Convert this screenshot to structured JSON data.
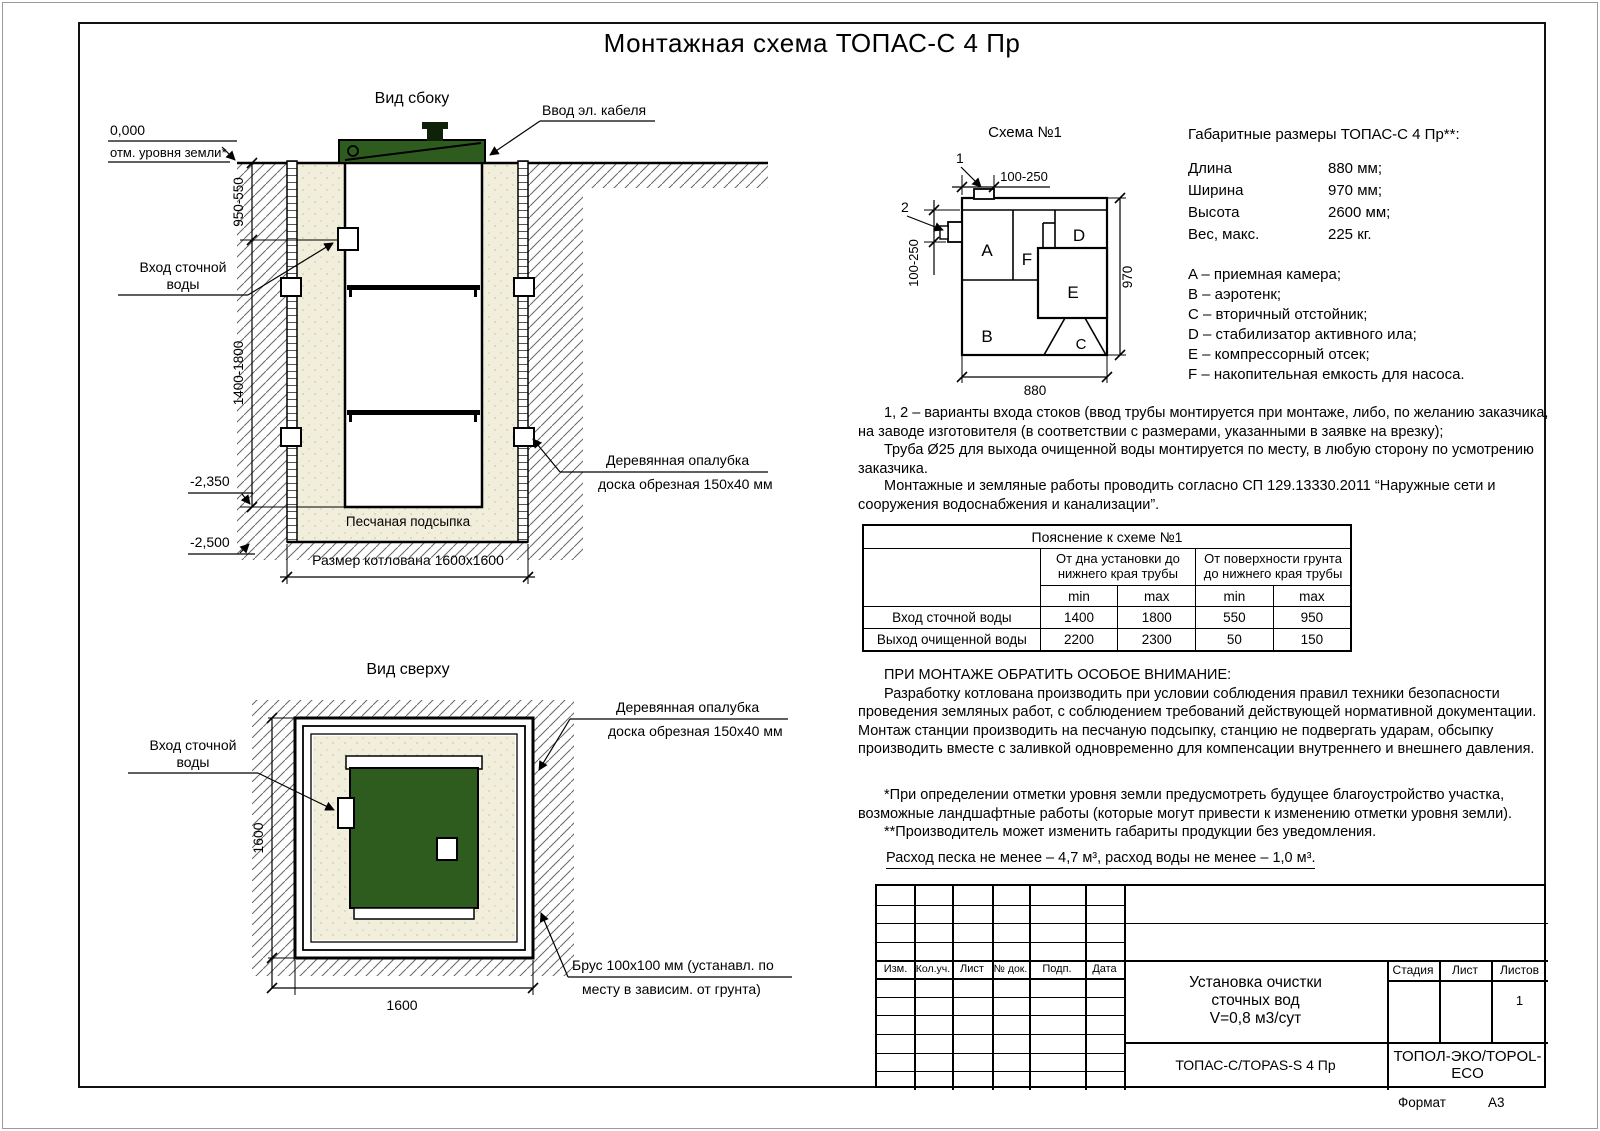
{
  "page": {
    "title": "Монтажная схема ТОПАС-С 4 Пр",
    "format_label": "Формат",
    "format_value": "А3"
  },
  "side_view": {
    "title": "Вид сбоку",
    "cable_label": "Ввод эл. кабеля",
    "level_zero": "0,000",
    "level_zero_note": "отм. уровня земли*",
    "dim_top": "950-550",
    "dim_mid": "1400-1800",
    "level_minus_1": "-2,350",
    "level_minus_2": "-2,500",
    "sand_label": "Песчаная подсыпка",
    "pit_label": "Размер котлована 1600х1600"
  },
  "top_view": {
    "title": "Вид сверху",
    "dim_side": "1600",
    "dim_bottom": "1600",
    "brus_line1": "Брус 100х100 мм (устанавл. по",
    "brus_line2": "месту в зависим. от грунта)"
  },
  "shared": {
    "inlet_line1": "Вход сточной",
    "inlet_line2": "воды",
    "formwork_line1": "Деревянная опалубка",
    "formwork_line2": "доска обрезная 150х40 мм"
  },
  "schema": {
    "title": "Схема №1",
    "marker_1": "1",
    "marker_2": "2",
    "dim_top": "100-250",
    "dim_left": "100-250",
    "dim_right": "970",
    "dim_bottom": "880",
    "compartments": {
      "a": "A",
      "b": "B",
      "c": "C",
      "d": "D",
      "e": "E",
      "f": "F"
    }
  },
  "specs": {
    "title": "Габаритные размеры ТОПАС-С 4 Пр**:",
    "rows": [
      {
        "name": "Длина",
        "value": "880 мм;"
      },
      {
        "name": "Ширина",
        "value": "970 мм;"
      },
      {
        "name": "Высота",
        "value": "2600 мм;"
      },
      {
        "name": "Вес, макс.",
        "value": "225 кг."
      }
    ],
    "legend": [
      "A – приемная камера;",
      "B – аэротенк;",
      "C – вторичный отстойник;",
      "D – стабилизатор активного ила;",
      "E – компрессорный отсек;",
      "F – накопительная емкость для насоса."
    ]
  },
  "notes": {
    "p1a": "1, 2 – варианты входа  стоков (ввод трубы монтируется при монтаже, либо, по желанию заказчика, на заводе изготовителя (в соответствии с размерами, указанными в заявке на врезку);",
    "p1b": "Труба Ø25 для выхода очищенной воды монтируется по месту, в любую сторону по усмотрению заказчика.",
    "p2": "Монтажные и земляные работы проводить согласно СП 129.13330.2011 “Наружные сети и сооружения водоснабжения и канализации”.",
    "attention_heading": "ПРИ МОНТАЖЕ ОБРАТИТЬ ОСОБОЕ ВНИМАНИЕ:",
    "attention_body": "Разработку котлована производить при условии соблюдения правил техники безопасности проведения земляных работ, с соблюдением требований действующей нормативной документации. Монтаж станции производить на песчаную подсыпку, станцию не подвергать ударам, обсыпку производить вместе с заливкой одновременно для компенсации внутреннего и внешнего давления.",
    "footnote_1": "*При определении отметки уровня земли предусмотреть будущее благоустройство участка, возможные ландшафтные работы (которые могут привести к изменению отметки уровня земли).",
    "footnote_2": "**Производитель может изменить габариты продукции без уведомления.",
    "consumption": "Расход песка не менее – 4,7 м³, расход воды не менее – 1,0 м³."
  },
  "table": {
    "title": "Пояснение к схеме №1",
    "group_1": "От дна установки до нижнего края трубы",
    "group_2": "От поверхности грунта до нижнего края трубы",
    "min": "min",
    "max": "max",
    "rows": [
      {
        "label": "Вход сточной воды",
        "values": [
          "1400",
          "1800",
          "550",
          "950"
        ]
      },
      {
        "label": "Выход очищенной воды",
        "values": [
          "2200",
          "2300",
          "50",
          "150"
        ]
      }
    ]
  },
  "stamp": {
    "columns": [
      "Изм.",
      "Кол.уч.",
      "Лист",
      "№ док.",
      "Подп.",
      "Дата"
    ],
    "doc_line1": "Установка очистки",
    "doc_line2": "сточных вод",
    "doc_line3": "V=0,8 м3/сут",
    "model": "ТОПАС-С/TOPAS-S 4 Пр",
    "company": "ТОПОЛ-ЭКО/TOPOL-ECO",
    "stage_label": "Стадия",
    "sheet_label": "Лист",
    "sheets_label": "Листов",
    "sheets_value": "1"
  },
  "colors": {
    "lid_green": "#2e5c1e",
    "sand": "#f1eedc",
    "line": "#000000"
  }
}
